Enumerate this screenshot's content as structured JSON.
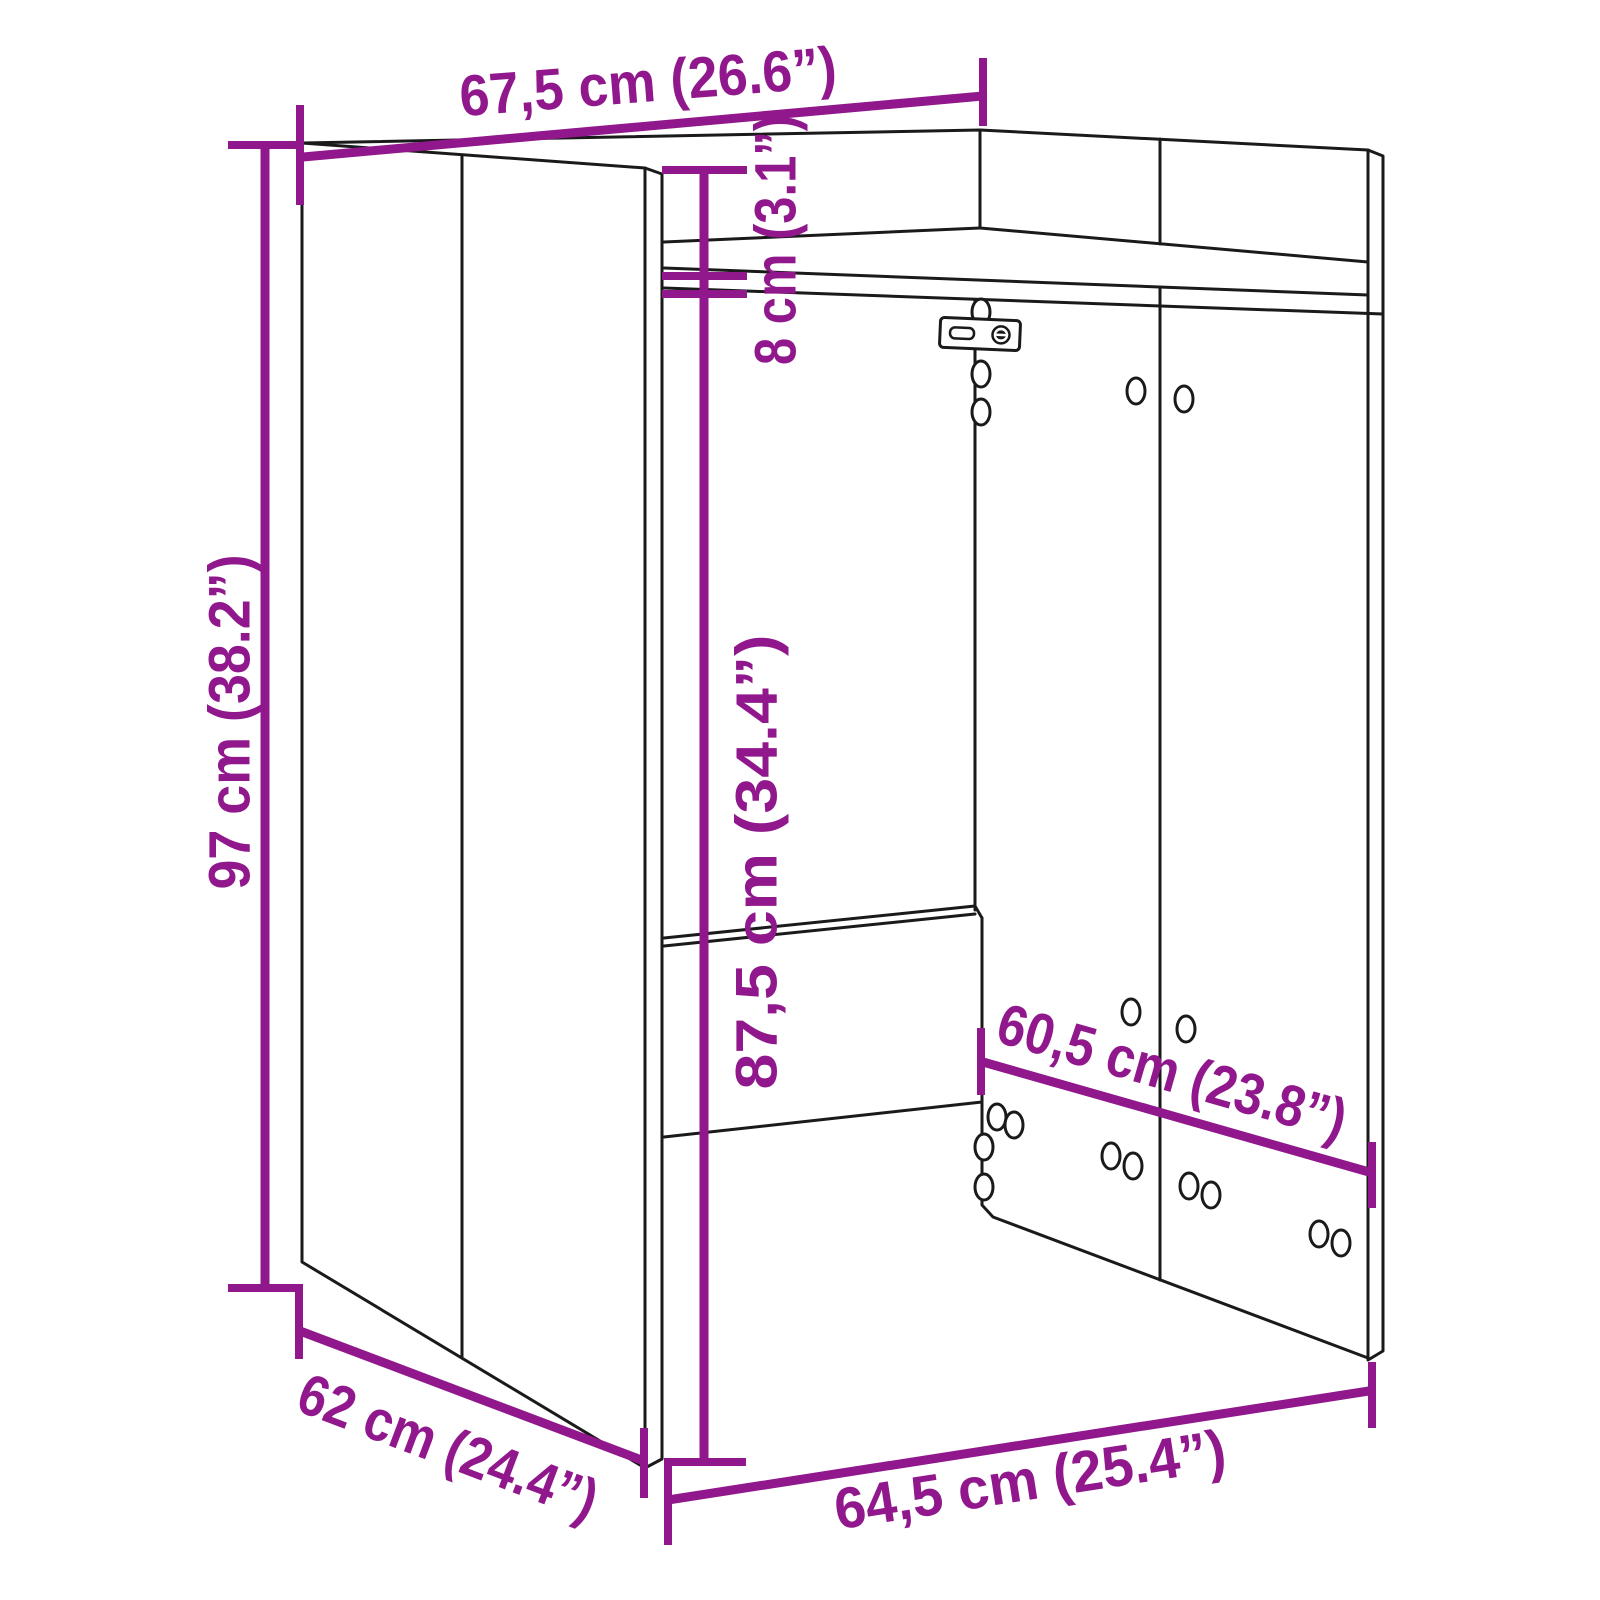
{
  "diagram": {
    "subject": "cabinet-dimension-drawing",
    "colors": {
      "outline": "#1a1a1a",
      "dimension": "#90188c",
      "background": "#ffffff"
    },
    "dimensions": {
      "top_width": "67,5 cm (26.6”)",
      "overall_height": "97 cm (38.2”)",
      "top_clearance": "8 cm (3.1”)",
      "inner_height": "87,5 cm (34.4”)",
      "inner_width": "60,5 cm (23.8”)",
      "depth": "62 cm (24.4”)",
      "bottom_width": "64,5 cm (25.4”)"
    }
  }
}
